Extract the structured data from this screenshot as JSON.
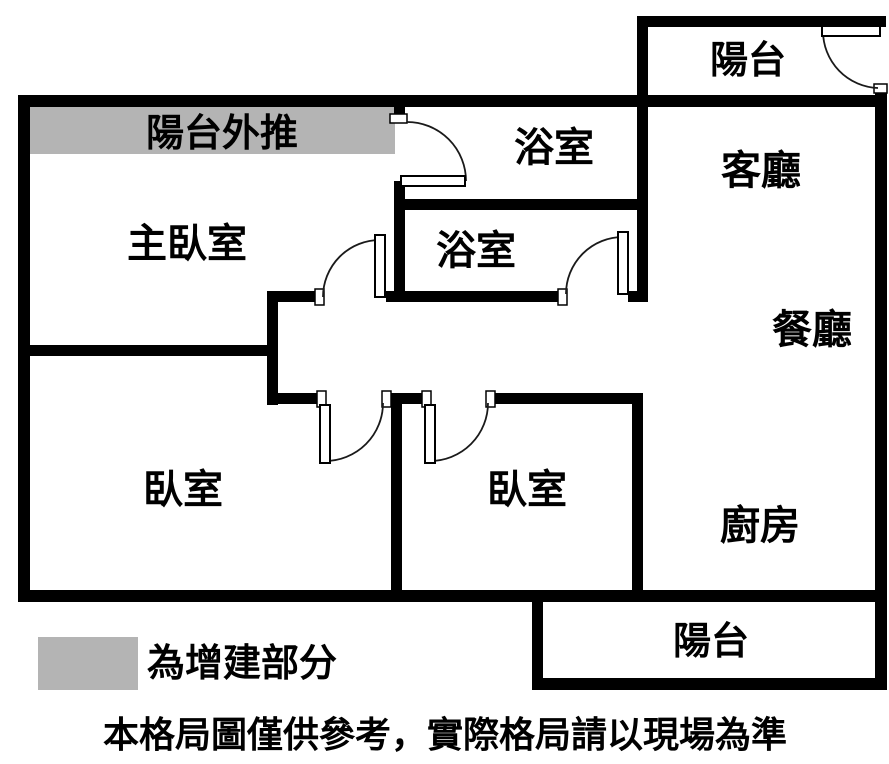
{
  "title": "apartment-floor-plan",
  "colors": {
    "wall": "#000000",
    "background": "#ffffff",
    "extension_fill": "#b4b4b4"
  },
  "rooms": {
    "balcony_top": "陽台",
    "balcony_extension": "陽台外推",
    "master_bedroom": "主臥室",
    "bathroom_upper": "浴室",
    "bathroom_lower": "浴室",
    "living_room": "客廳",
    "dining_room": "餐廳",
    "bedroom_left": "臥室",
    "bedroom_middle": "臥室",
    "kitchen": "廚房",
    "balcony_bottom": "陽台"
  },
  "legend": {
    "label": "為增建部分",
    "swatch_color": "#b4b4b4"
  },
  "disclaimer": "本格局圖僅供參考，實際格局請以現場為準"
}
